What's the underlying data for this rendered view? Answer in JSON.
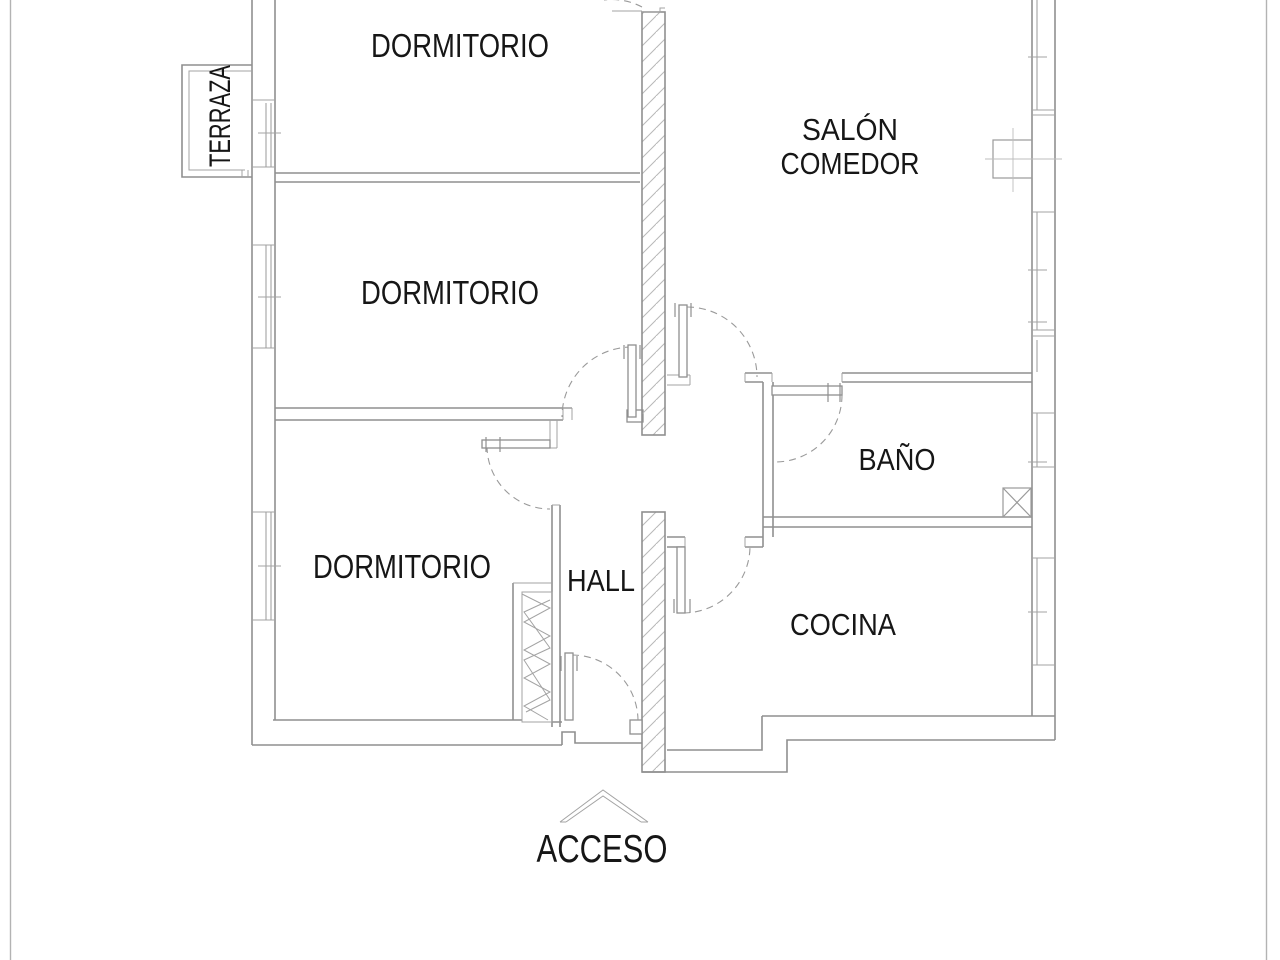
{
  "plan": {
    "labels": {
      "dormitorio_top": "DORMITORIO",
      "salon_line1": "SALÓN",
      "salon_line2": "COMEDOR",
      "dormitorio_middle": "DORMITORIO",
      "bano": "BAÑO",
      "dormitorio_bottom": "DORMITORIO",
      "hall": "HALL",
      "cocina": "COCINA",
      "terraza": "TERRAZA",
      "acceso": "ACCESO"
    },
    "colors": {
      "background": "#ffffff",
      "wall_line": "#8f8f8f",
      "thin_line": "#a3a3a3",
      "hatch_line": "#b8b8b8",
      "dash_line": "#9a9a9a",
      "page_border": "#b3b3b3",
      "text": "#161616"
    }
  }
}
